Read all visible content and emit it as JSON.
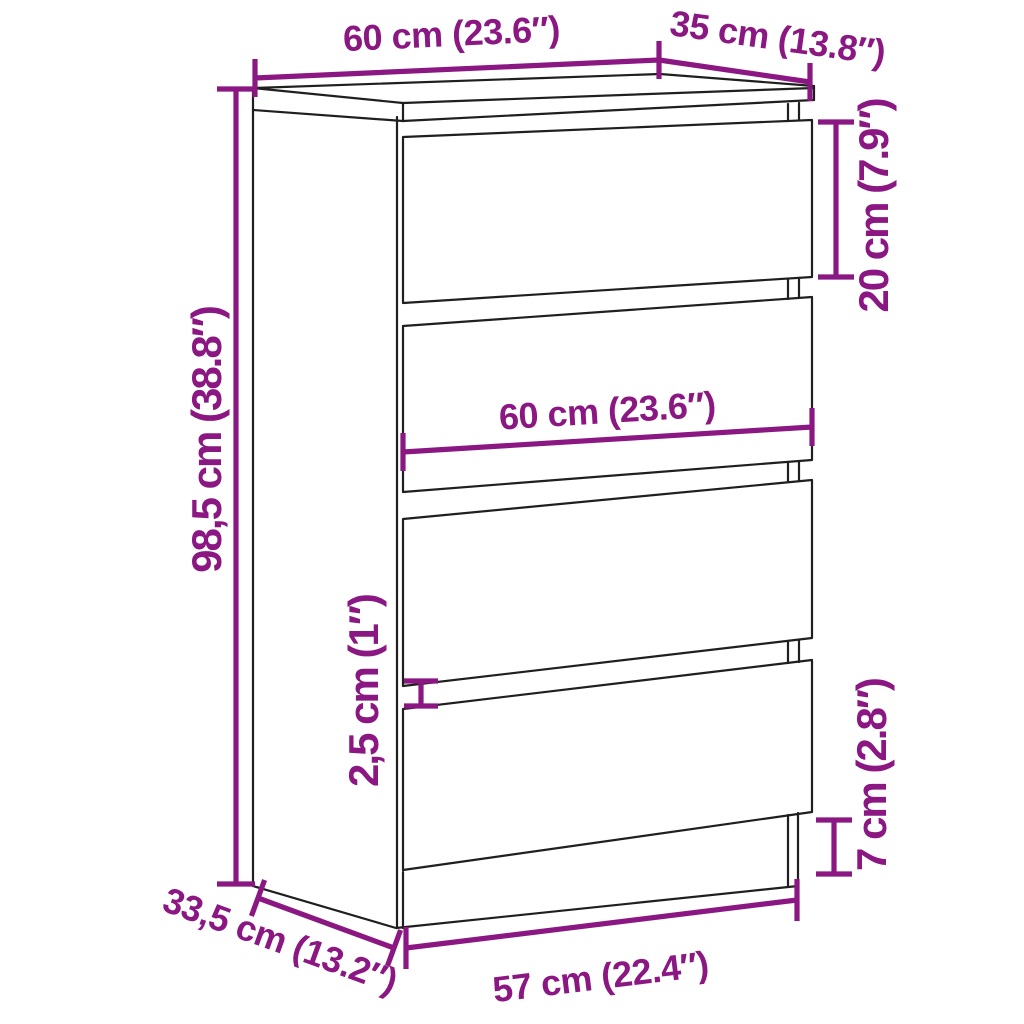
{
  "page": {
    "background": "#ffffff",
    "description": "Dimension diagram of a chest of drawers with four drawers"
  },
  "diagram": {
    "product": "chest-of-drawers-4-drawers",
    "line_color": "#1f1f1f",
    "dimension_color": "#8B1782",
    "labels": {
      "top_width": "60 cm (23.6″)",
      "top_depth": "35 cm (13.8″)",
      "drawer_height": "20 cm (7.9″)",
      "drawer_width": "60 cm (23.6″)",
      "overall_height": "98,5 cm (38.8″)",
      "drawer_gap": "2,5 cm (1″)",
      "base_height": "7 cm (2.8″)",
      "base_width": "57 cm (22.4″)",
      "base_depth": "33,5 cm (13.2″)"
    }
  }
}
